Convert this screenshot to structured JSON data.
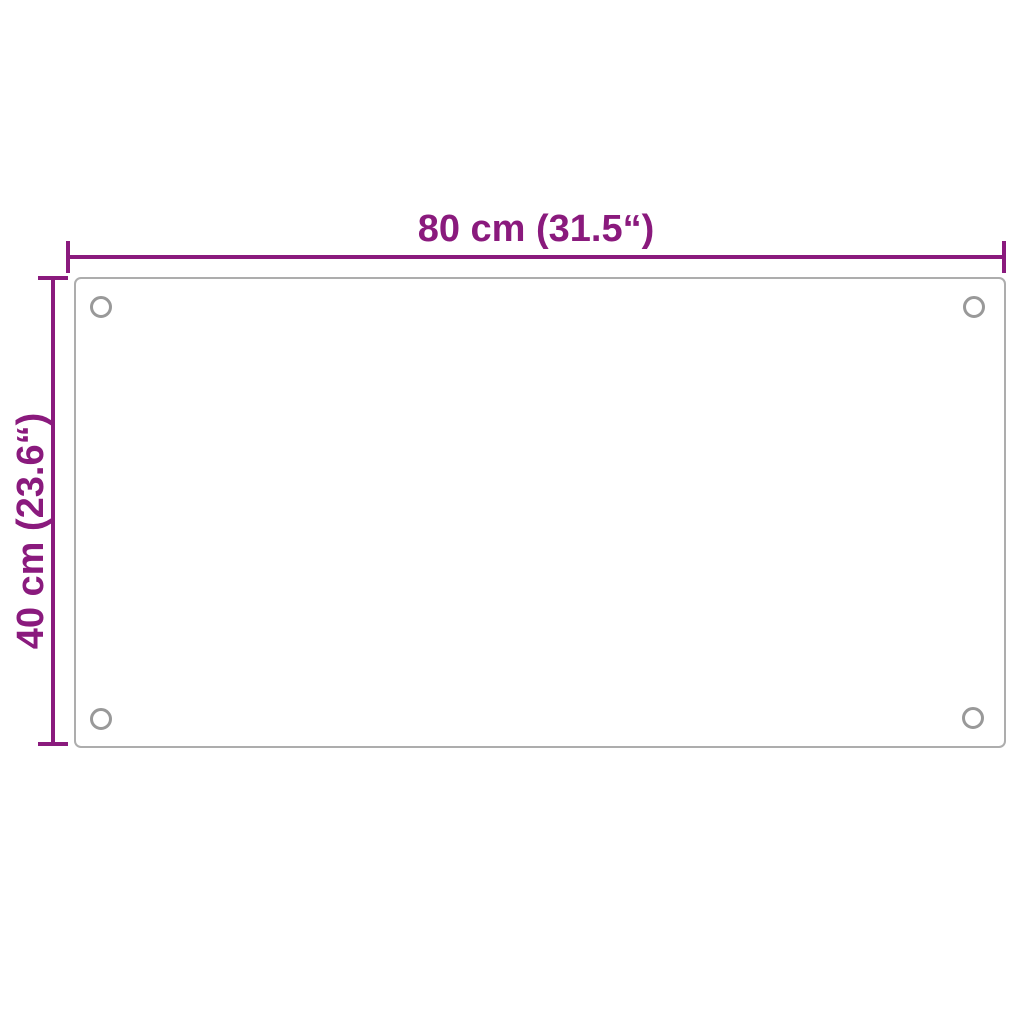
{
  "diagram": {
    "type": "product-dimension-diagram",
    "width_label": "80 cm (31.5“)",
    "height_label": "40 cm (23.6“)",
    "panel": {
      "shape": "rectangle",
      "aspect_ratio": "2:1",
      "mounting_hole_count": 4
    },
    "colors": {
      "dimension_accent": "#8a1a7d",
      "panel_border": "#adadad",
      "hole_stroke": "#999999",
      "background": "#ffffff"
    }
  }
}
